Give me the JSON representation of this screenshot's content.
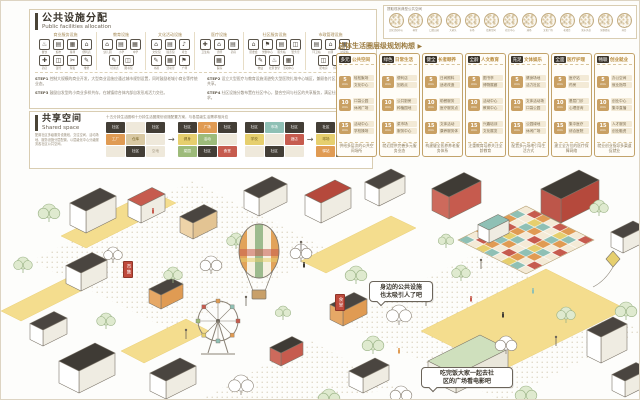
{
  "facilities_panel": {
    "title": "公共设施分配",
    "subtitle": "Public facilities allocation",
    "groups": [
      {
        "header": "商业服务设施",
        "items": [
          {
            "icon": "♨",
            "label": "餐饮"
          },
          {
            "icon": "▤",
            "label": "超市"
          },
          {
            "icon": "▦",
            "label": "菜场"
          },
          {
            "icon": "⌂",
            "label": "便利店"
          },
          {
            "icon": "✚",
            "label": "药店"
          },
          {
            "icon": "◫",
            "label": "银行"
          },
          {
            "icon": "✂",
            "label": "理发"
          },
          {
            "icon": "✎",
            "label": "维修"
          }
        ]
      },
      {
        "header": "教育设施",
        "items": [
          {
            "icon": "⌂",
            "label": "幼儿园"
          },
          {
            "icon": "▤",
            "label": "小学"
          },
          {
            "icon": "▦",
            "label": "中学"
          },
          {
            "icon": "✎",
            "label": "培训点"
          },
          {
            "icon": "◫",
            "label": "图书馆"
          }
        ]
      },
      {
        "header": "文化活动设施",
        "items": [
          {
            "icon": "⌂",
            "label": "文化馆"
          },
          {
            "icon": "▤",
            "label": "展览馆"
          },
          {
            "icon": "♪",
            "label": "戏台"
          },
          {
            "icon": "✎",
            "label": "书屋"
          },
          {
            "icon": "▦",
            "label": "活动室"
          },
          {
            "icon": "⚑",
            "label": "广场"
          }
        ]
      },
      {
        "header": "医疗设施",
        "items": [
          {
            "icon": "✚",
            "label": "卫生站"
          },
          {
            "icon": "⌂",
            "label": "诊所"
          },
          {
            "icon": "▤",
            "label": "药房"
          },
          {
            "icon": "▦",
            "label": "医院"
          }
        ]
      },
      {
        "header": "社区服务设施",
        "items": [
          {
            "icon": "⌂",
            "label": "居委会"
          },
          {
            "icon": "⚑",
            "label": "党群中心"
          },
          {
            "icon": "▤",
            "label": "服务站"
          },
          {
            "icon": "◫",
            "label": "警务室"
          },
          {
            "icon": "✎",
            "label": "物业"
          },
          {
            "icon": "♨",
            "label": "社区食堂"
          },
          {
            "icon": "▦",
            "label": "活动中心"
          }
        ]
      },
      {
        "header": "市政管理设施",
        "items": [
          {
            "icon": "▤",
            "label": "环卫站"
          },
          {
            "icon": "⌂",
            "label": "公厕"
          },
          {
            "icon": "▦",
            "label": "垃圾站"
          },
          {
            "icon": "◫",
            "label": "配电房"
          },
          {
            "icon": "P",
            "label": "停车场"
          }
        ]
      }
    ],
    "steps": [
      {
        "tag": "STEP1",
        "text": "控制大规模的商业开发，大型商业设施应通过城市规划设置，同时鼓励老城小商业等传统业态。"
      },
      {
        "tag": "STEP2",
        "text": "设立大型医疗与教育设施须避免大型医院扎堆中心城区，兼顾各片区、特型街区设施资源共享。"
      },
      {
        "tag": "STEP3",
        "text": "鼓励自发型的小商业多样共存，在城镇综合体内部自发形成活力交往。"
      },
      {
        "tag": "STEP4",
        "text": "社区设施分散布置在社区中心，整合空间与社区的共享服务，满足社区内部人群多样需求。"
      }
    ]
  },
  "shared_panel": {
    "title": "共享空间",
    "subtitle": "Shared space",
    "description": "配置社区多级服务设施段，交往空间、活动场地、服务设施分层配置，以层级化中心分级服务各社区公共空间。",
    "note": "十五分钟生活圈和十分钟生活圈规划设施配置方案，与各层级生活需求相对应",
    "arrow": "→",
    "pairs": [
      {
        "before": [
          {
            "t": "社区",
            "c": "dark"
          },
          {
            "t": "",
            "c": "plain"
          },
          {
            "t": "社区",
            "c": "dark"
          },
          {
            "t": "工厂",
            "c": "orange"
          },
          {
            "t": "仓库",
            "c": "tan"
          },
          {
            "t": "",
            "c": "plain"
          },
          {
            "t": "",
            "c": "plain"
          },
          {
            "t": "社区",
            "c": "dark"
          },
          {
            "t": "空地",
            "c": "plain"
          }
        ],
        "after": [
          {
            "t": "社区",
            "c": "dark"
          },
          {
            "t": "广场",
            "c": "orange"
          },
          {
            "t": "社区",
            "c": "dark"
          },
          {
            "t": "健身",
            "c": "yellow"
          },
          {
            "t": "活动",
            "c": "green"
          },
          {
            "t": "",
            "c": "plain"
          },
          {
            "t": "菜园",
            "c": "green"
          },
          {
            "t": "社区",
            "c": "dark"
          },
          {
            "t": "食堂",
            "c": "red"
          }
        ]
      },
      {
        "before": [
          {
            "t": "社区",
            "c": "dark"
          },
          {
            "t": "市场",
            "c": "cyan"
          },
          {
            "t": "社区",
            "c": "dark"
          },
          {
            "t": "学校",
            "c": "yellow"
          },
          {
            "t": "",
            "c": "plain"
          },
          {
            "t": "酒店",
            "c": "red"
          },
          {
            "t": "",
            "c": "plain"
          },
          {
            "t": "社区",
            "c": "dark"
          },
          {
            "t": "",
            "c": "plain"
          }
        ],
        "after": [
          {
            "t": "社区",
            "c": "dark"
          },
          {
            "t": "书屋",
            "c": "cyan"
          },
          {
            "t": "社区",
            "c": "dark"
          },
          {
            "t": "球场",
            "c": "yellow"
          },
          {
            "t": "舞台",
            "c": "red"
          },
          {
            "t": "花园",
            "c": "green"
          },
          {
            "t": "驿站",
            "c": "orange"
          },
          {
            "t": "社区",
            "c": "dark"
          },
          {
            "t": "广场",
            "c": "yellow"
          }
        ]
      }
    ]
  },
  "photos_panel": {
    "title": "提取现状典型公共空间",
    "circles": [
      {
        "label": "文化活动中心"
      },
      {
        "label": "祠堂"
      },
      {
        "label": "口袋公园"
      },
      {
        "label": "大树头"
      },
      {
        "label": "市场"
      },
      {
        "label": "街角空间"
      },
      {
        "label": "社区中心"
      },
      {
        "label": "球场"
      },
      {
        "label": "文化广场"
      },
      {
        "label": "老戏台"
      },
      {
        "label": "滨水步道"
      },
      {
        "label": "党群驿站"
      },
      {
        "label": "井台"
      }
    ]
  },
  "plan_panel": {
    "header": "总体生活圈层级规划构想",
    "arrow": "▶",
    "cards": [
      {
        "badge": "多元",
        "title": "公共空间",
        "rows": [
          {
            "time": "5",
            "unit": "min",
            "line1": "轻松聚场",
            "line2": "文化中心"
          },
          {
            "time": "10",
            "unit": "min",
            "line1": "口袋公园",
            "line2": "休闲广场"
          },
          {
            "time": "15",
            "unit": "min",
            "line1": "活动中心",
            "line2": "学校操场"
          }
        ],
        "summary": "供给多层次的公共空间场所"
      },
      {
        "badge": "绿色",
        "title": "日常生活",
        "rows": [
          {
            "time": "5",
            "unit": "min",
            "line1": "便利店",
            "line2": "回收点"
          },
          {
            "time": "10",
            "unit": "min",
            "line1": "公共厨房",
            "line2": "种植园地"
          },
          {
            "time": "15",
            "unit": "min",
            "line1": "菜市场",
            "line2": "服务中心"
          }
        ],
        "summary": "就近提供完善多元服务业态"
      },
      {
        "badge": "健全",
        "title": "长者颐养",
        "rows": [
          {
            "time": "5",
            "unit": "min",
            "line1": "日间照料",
            "line2": "适老改造"
          },
          {
            "time": "10",
            "unit": "min",
            "line1": "助餐服务",
            "line2": "医疗服务点"
          },
          {
            "time": "15",
            "unit": "min",
            "line1": "文体活动",
            "line2": "康养服务体"
          }
        ],
        "summary": "构建健全医养养老服务体系"
      },
      {
        "badge": "全龄",
        "title": "人文教育",
        "rows": [
          {
            "time": "5",
            "unit": "min",
            "line1": "图书亭",
            "line2": "博物展廊"
          },
          {
            "time": "10",
            "unit": "min",
            "line1": "活动中心",
            "line2": "教育中心"
          },
          {
            "time": "15",
            "unit": "min",
            "line1": "兴趣培训",
            "line2": "文化展览"
          }
        ],
        "summary": "注重教育培养关注全龄教育"
      },
      {
        "badge": "充足",
        "title": "文体娱乐",
        "rows": [
          {
            "time": "5",
            "unit": "min",
            "line1": "健身场地",
            "line2": "活力社区"
          },
          {
            "time": "10",
            "unit": "min",
            "line1": "文体活动场",
            "line2": "口袋公园"
          },
          {
            "time": "15",
            "unit": "min",
            "line1": "公园绿地",
            "line2": "休闲广场"
          }
        ],
        "summary": "配置多元场地引导生活方式"
      },
      {
        "badge": "全面",
        "title": "医疗护理",
        "rows": [
          {
            "time": "5",
            "unit": "min",
            "line1": "医疗站",
            "line2": "药房"
          },
          {
            "time": "10",
            "unit": "min",
            "line1": "基层门诊",
            "line2": "心理咨询"
          },
          {
            "time": "15",
            "unit": "min",
            "line1": "集中医疗",
            "line2": "综合医院"
          }
        ],
        "summary": "建立全方位的医疗保障网络"
      },
      {
        "badge": "畅联",
        "title": "创业就业",
        "rows": [
          {
            "time": "5",
            "unit": "min",
            "line1": "办公空间",
            "line2": "就业指导"
          },
          {
            "time": "10",
            "unit": "min",
            "line1": "创业中心",
            "line2": "集中直播"
          },
          {
            "time": "15",
            "unit": "min",
            "line1": "人才服务",
            "line2": "创业融资"
          }
        ],
        "summary": "就业创业指导多渠道促就业"
      }
    ]
  },
  "illustration": {
    "bubble1": {
      "line1": "身边的公共设施",
      "line2": "也太吸引人了吧"
    },
    "bubble2": {
      "line1": "吃完饭大家一起去社",
      "line2": "区的广场看电影吧"
    },
    "banner1": "食堂",
    "banner2": "市集"
  }
}
